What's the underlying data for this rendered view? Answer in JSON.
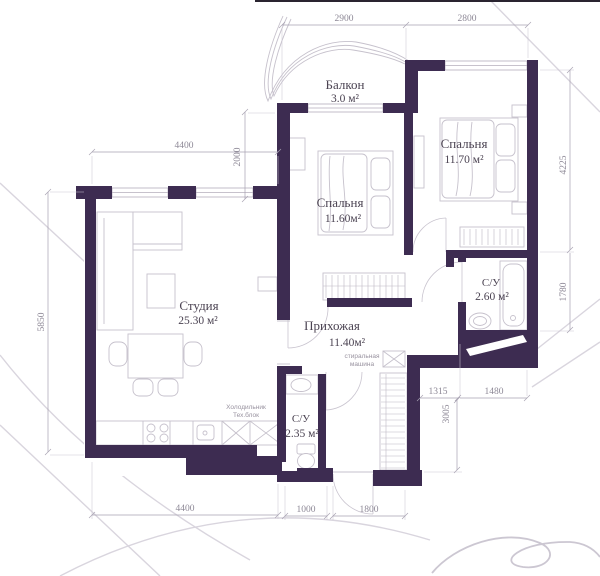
{
  "plan": {
    "rooms": {
      "balcony": {
        "name": "Балкон",
        "area": "3.0 м²"
      },
      "bedroom_center": {
        "name": "Спальня",
        "area": "11.60м²"
      },
      "bedroom_right": {
        "name": "Спальня",
        "area": "11.70 м²"
      },
      "studio": {
        "name": "Студия",
        "area": "25.30 м²"
      },
      "hallway": {
        "name": "Прихожая",
        "area": "11.40м²"
      },
      "bathroom_right": {
        "name": "С/У",
        "area": "2.60 м²"
      },
      "bathroom_lower": {
        "name": "С/У",
        "area": "2.35 м²"
      }
    },
    "annotations": {
      "washing_machine": [
        "стиральная",
        "машина"
      ],
      "fridge_tech": [
        "Холодильник",
        "Тех.блок"
      ]
    },
    "dimensions": {
      "balcony_width": "2900",
      "bedroom_right_width": "2800",
      "studio_width_top": "4400",
      "recess_height": "2000",
      "left_height": "5850",
      "bedroom_right_height": "4225",
      "bathroom_right_height": "1780",
      "nook_width": "1315",
      "hall_lower_height": "3005",
      "bathroom_right_width": "1480",
      "studio_width_bottom": "4400",
      "bathroom_lower_width": "1000",
      "entrance_width": "1800"
    },
    "colors": {
      "wall": "#3d2c51",
      "line": "#c6c1cc",
      "dim": "#a8a2b2",
      "dim_text": "#8d8896",
      "room_text": "#4b4352"
    }
  }
}
